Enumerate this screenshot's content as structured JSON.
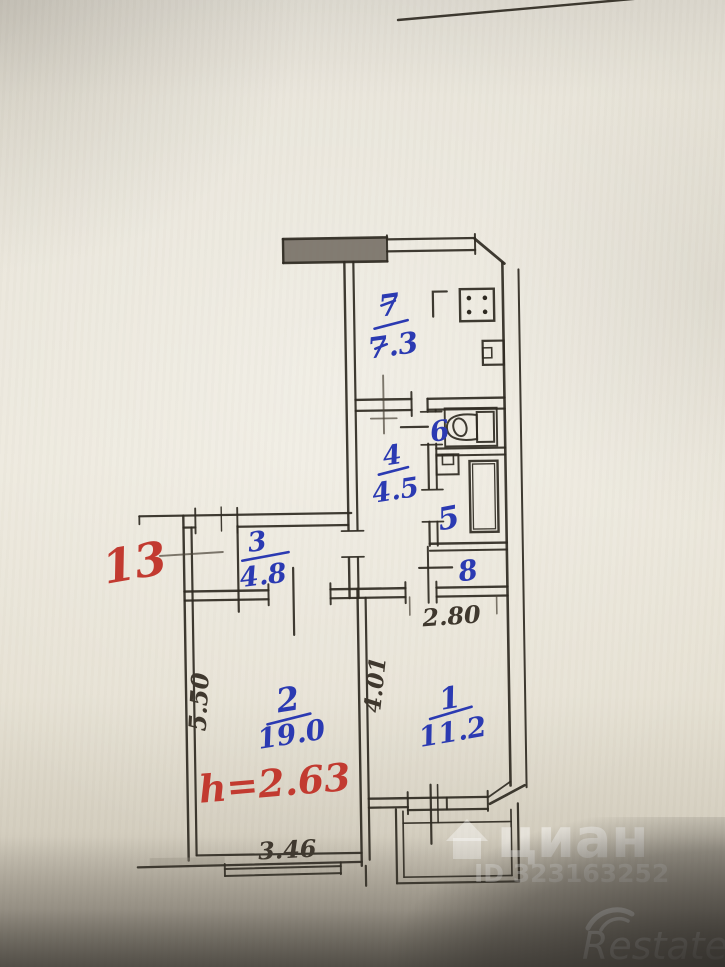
{
  "document": {
    "type": "scanned apartment floor plan (BTI drawing)"
  },
  "rooms": {
    "kitchen": {
      "number": "7",
      "area": "7.3"
    },
    "toilet": {
      "number": "6"
    },
    "corridor": {
      "number": "4",
      "area": "4.5"
    },
    "bathroom": {
      "number": "5"
    },
    "closet": {
      "number": "8"
    },
    "hallway": {
      "number": "3",
      "area": "4.8"
    },
    "living": {
      "number": "2",
      "area": "19.0"
    },
    "bedroom": {
      "number": "1",
      "area": "11.2"
    }
  },
  "annotations": {
    "apartment_number": "13",
    "ceiling_height": "h=2.63"
  },
  "dimensions": {
    "living_width": "3.46",
    "living_depth": "5.50",
    "bedroom_width": "2.80",
    "bedroom_depth": "4.01"
  },
  "watermarks": {
    "cian": "циан",
    "cian_id": "ID 323163252",
    "restate": "Restate"
  },
  "colors": {
    "ink": "#2f2a22",
    "handwriting_blue": "#2b3ab2",
    "handwriting_red": "#c23a30",
    "pencil": "#4a4338",
    "paper": "#e9e5d9"
  }
}
